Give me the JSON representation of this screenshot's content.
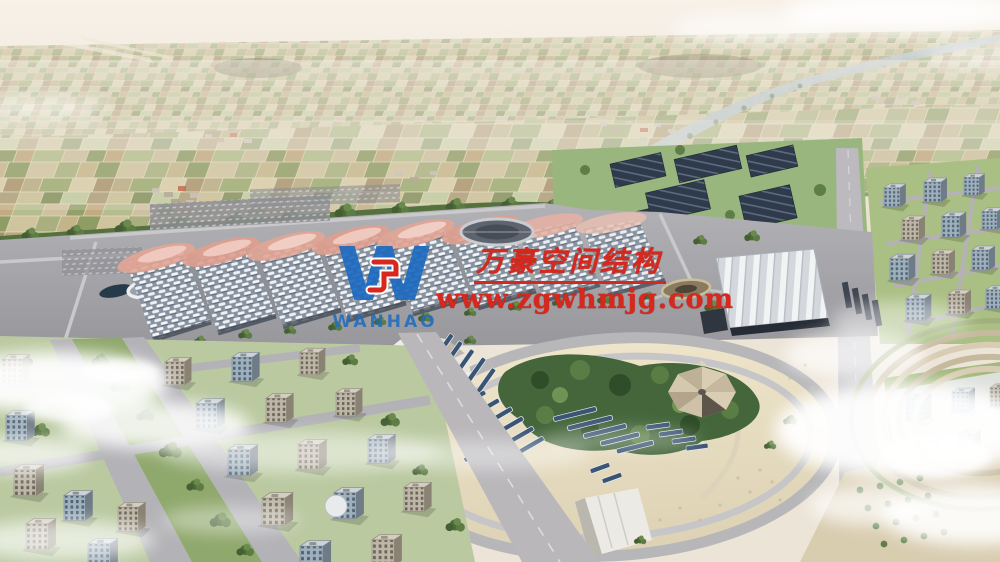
{
  "watermark": {
    "company_name": "万豪空间结构",
    "website": "www.zgwhmjg.com",
    "logo_letter": "W",
    "logo_wordmark": "WANHAO",
    "red": "#d7281e",
    "blue": "#1e6bbf"
  },
  "scene": {
    "palette": {
      "sky_haze": "#f2ebe1",
      "farmland_tan": "#cdc19c",
      "farmland_olive": "#a8ad7c",
      "tree_green": "#4e6a3a",
      "plaza_grey": "#a2a2a7",
      "hall_roof_grey": "#8792a0",
      "membrane_pink": "#e2a595",
      "solar_panel_navy": "#31405a",
      "park_ground_beige": "#e7ddc2",
      "road_grey": "#b6b4b6",
      "cloud_white": "#ffffff"
    }
  }
}
